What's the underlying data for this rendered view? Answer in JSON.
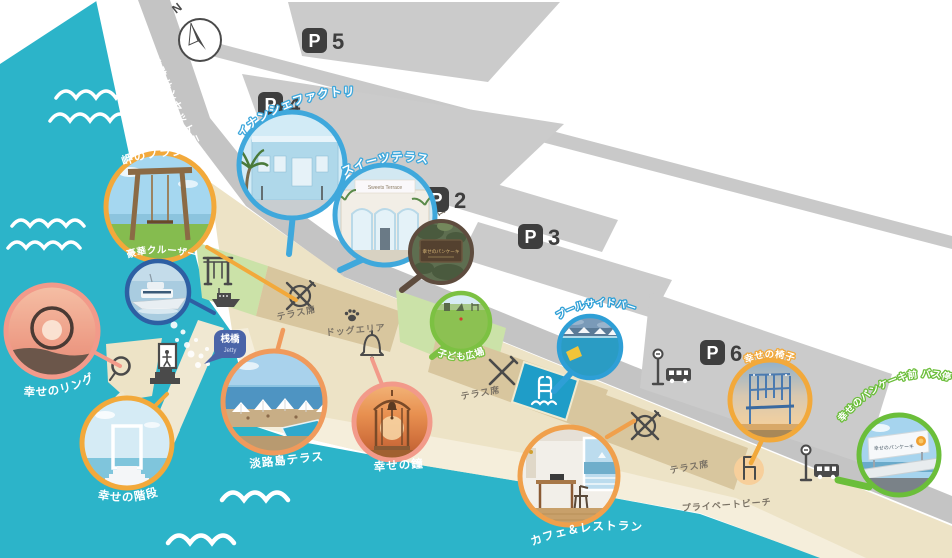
{
  "map": {
    "compass": {
      "label": "N"
    },
    "road": {
      "name_jp": "淡路サンセットライン",
      "name_en": "Awaji Sunset line"
    },
    "parking": {
      "p_glyph": "P",
      "p2": "2",
      "p3": "3",
      "p4": "4",
      "p5": "5",
      "p6": "6"
    },
    "labels": {
      "jetty_jp": "桟橋",
      "jetty_en": "Jetty",
      "terrace_seats": "テラス席",
      "dog_area": "ドッグエリア",
      "entrance": "入口",
      "private_beach": "プライベートビーチ"
    },
    "spots": [
      {
        "id": "misaki-no-blanco",
        "label": "岬のブランコ",
        "accent": "#F2A93B"
      },
      {
        "id": "gouka-cruiser",
        "label": "豪華クルーザー",
        "accent": "#2E5FA3"
      },
      {
        "id": "shiawase-no-ring",
        "label": "幸せのリング",
        "accent": "#F29A8A"
      },
      {
        "id": "shiawase-no-kaidan",
        "label": "幸せの階段",
        "accent": "#F2A93B"
      },
      {
        "id": "financier-factory",
        "label": "フィナンシェファクトリー",
        "accent": "#3FA8DC"
      },
      {
        "id": "sweets-terrace",
        "label": "スイーツテラス",
        "accent": "#3FA8DC",
        "sign_text": "Sweets Terrace"
      },
      {
        "id": "entrance-sign",
        "label": "",
        "accent": "#5E4C3E",
        "sign_text": "幸せのパンケーキ"
      },
      {
        "id": "kodomo-hiroba",
        "label": "子ども広場",
        "accent": "#7CC142"
      },
      {
        "id": "poolside-bar",
        "label": "プールサイドバー",
        "accent": "#2E9FD6"
      },
      {
        "id": "shiawase-no-isu",
        "label": "幸せの椅子",
        "accent": "#F2A93B"
      },
      {
        "id": "pancake-mae-bus-stop",
        "label": "幸せのパンケーキ前 バス停",
        "accent": "#6BBE3A",
        "sign_text": "幸せのパンケーキ"
      },
      {
        "id": "awajishima-terrace",
        "label": "淡路島テラス",
        "accent": "#F09A5C"
      },
      {
        "id": "shiawase-no-kane",
        "label": "幸せの鐘",
        "accent": "#F29A8A"
      },
      {
        "id": "cafe-restaurant",
        "label": "カフェ＆レストラン",
        "accent": "#F0A04C"
      }
    ],
    "colors": {
      "ocean": "#2CB4C9",
      "road": "#C4C4C4",
      "parking_lot": "#CBCBCB",
      "resort": "#EDE3C6",
      "sand": "#F5EEDB",
      "lawn": "#CBE2A8",
      "terrace": "#D8C69E",
      "pool": "#1F9DC8",
      "icon": "#4A4A4A",
      "jetty_badge": "#4A64A8"
    },
    "icons": [
      "compass-icon",
      "swing-icon",
      "ferry-icon",
      "dining-icon",
      "fork-knife-icon",
      "paw-icon",
      "bell-icon",
      "pool-ladder-icon",
      "stairs-icon",
      "ring-icon",
      "chair-icon",
      "bus-stop-icon",
      "parking-icon",
      "wave-icon"
    ]
  }
}
